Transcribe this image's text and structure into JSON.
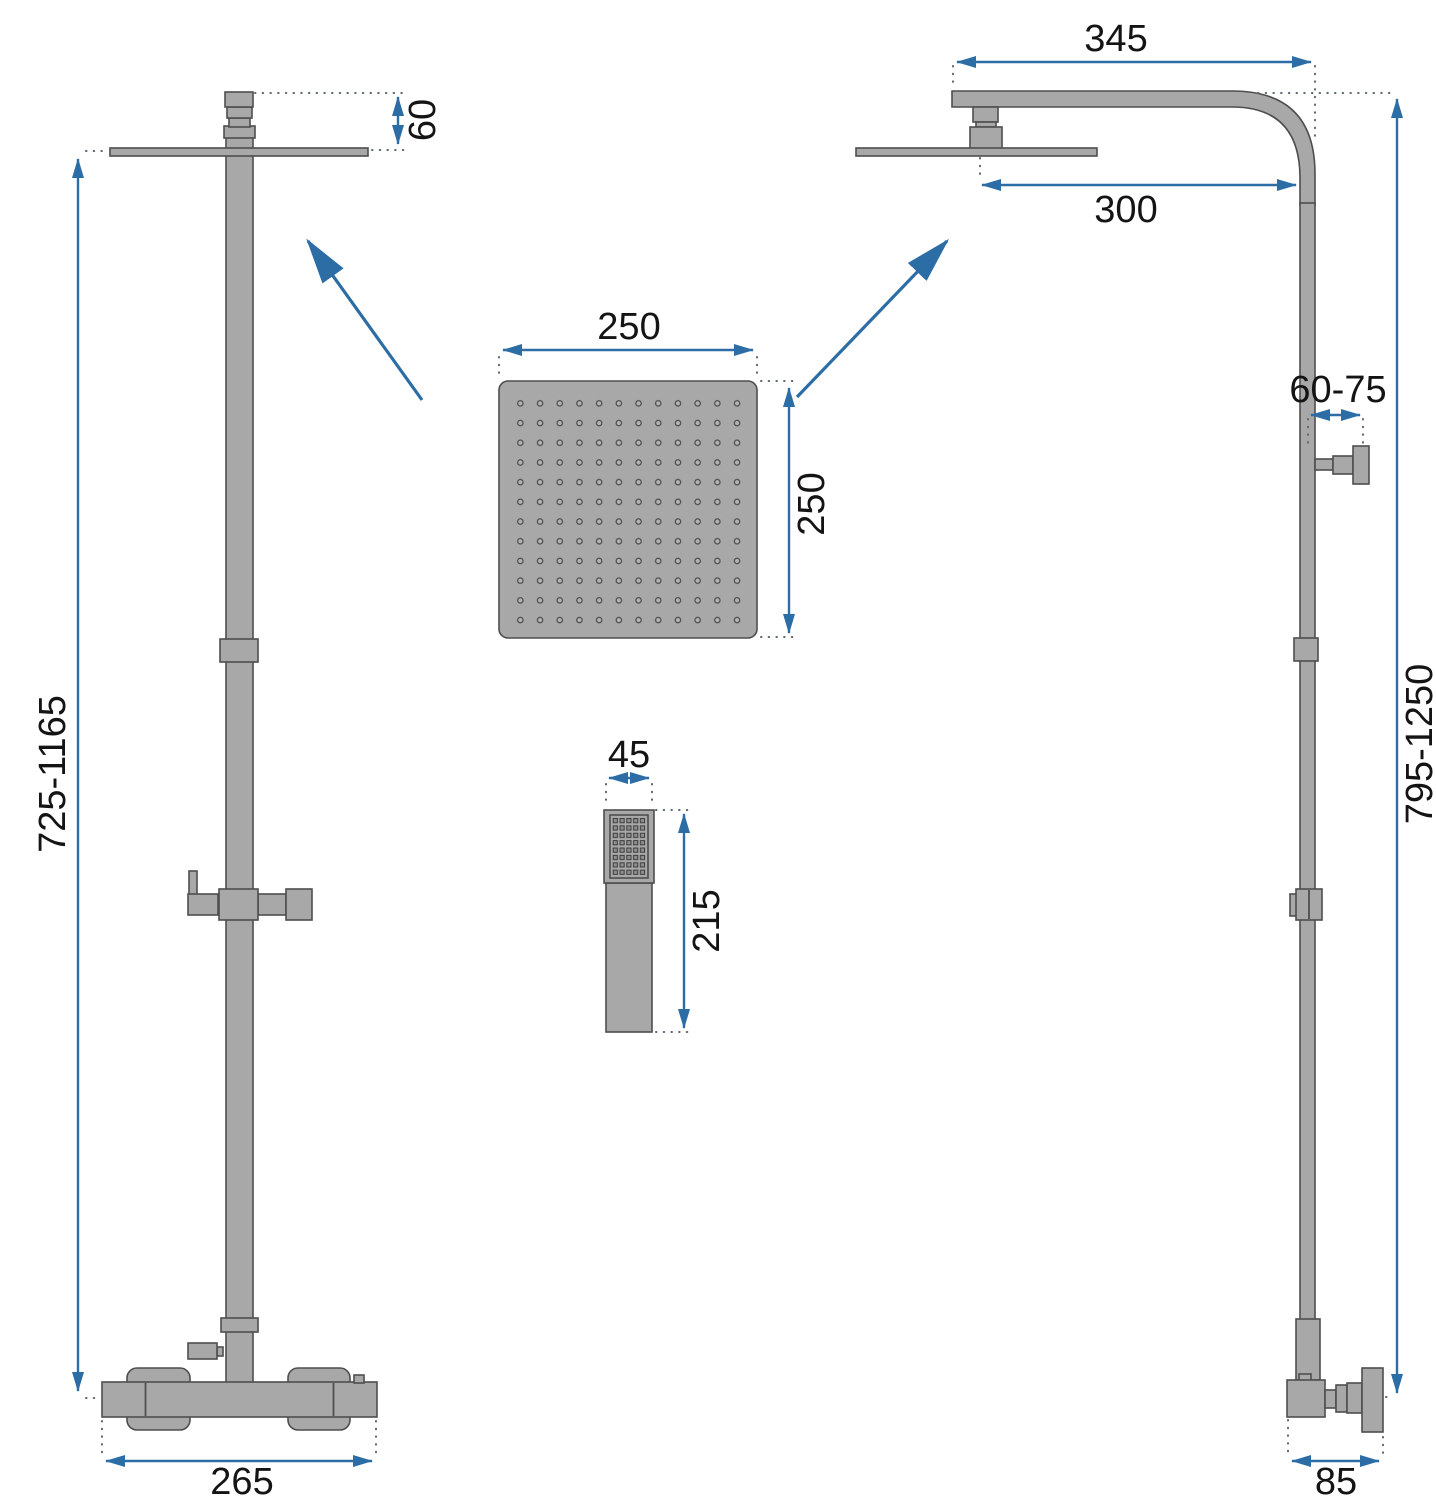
{
  "drawing": {
    "kind": "shower-set-technical-drawing",
    "colors": {
      "dimension_blue": "#2d6da6",
      "part_fill": "#a8a8a8",
      "part_outline": "#4e4e4e",
      "text": "#141414"
    },
    "front_view": {
      "head_offset": "60",
      "height_range": "725-1165",
      "base_width": "265"
    },
    "side_view": {
      "arm_length": "345",
      "head_reach": "300",
      "wall_offset": "60-75",
      "height_range": "795-1250",
      "base_depth": "85"
    },
    "rain_head_detail": {
      "width": "250",
      "depth": "250"
    },
    "hand_shower_detail": {
      "width": "45",
      "length": "215"
    }
  }
}
